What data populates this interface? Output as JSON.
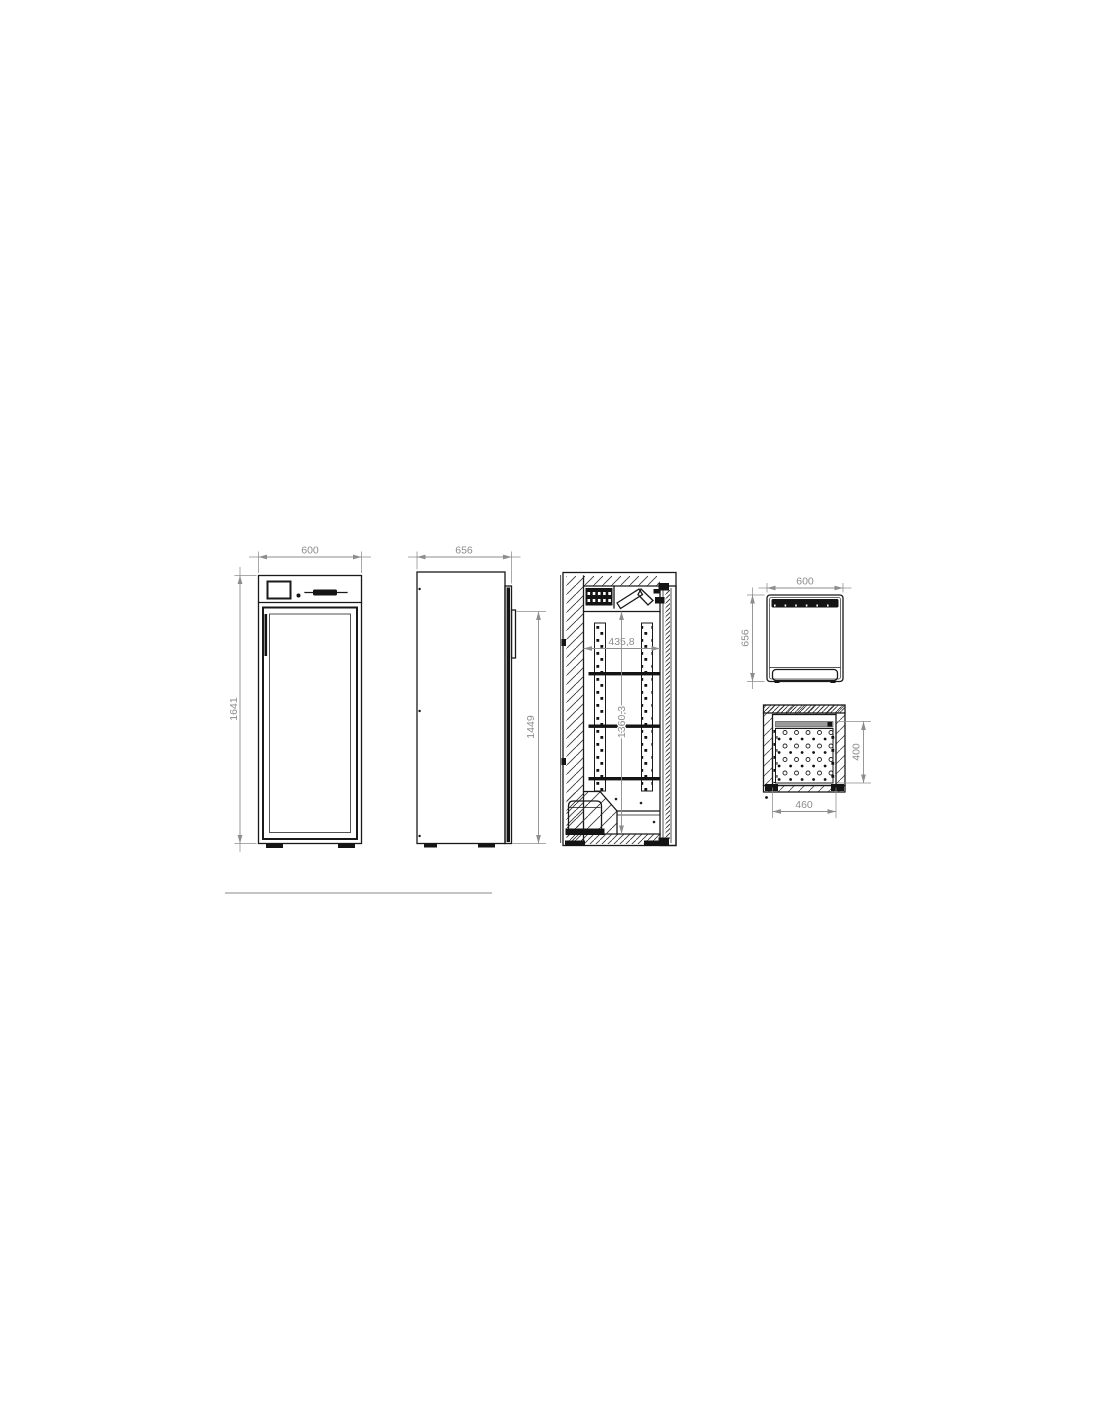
{
  "drawing_type": "technical-drawing-refrigerated-cabinet",
  "colors": {
    "line": "#1a1a1a",
    "dimension": "#8d8d8d",
    "background": "#ffffff"
  },
  "dims": {
    "front": {
      "width": "600",
      "height": "1641"
    },
    "side": {
      "depth": "656",
      "door_height": "1449"
    },
    "section": {
      "inner_width": "435,8",
      "inner_height": "1360,3"
    },
    "top": {
      "width": "600",
      "depth": "656"
    },
    "bottom": {
      "plate_depth": "400",
      "plate_width": "460"
    }
  }
}
